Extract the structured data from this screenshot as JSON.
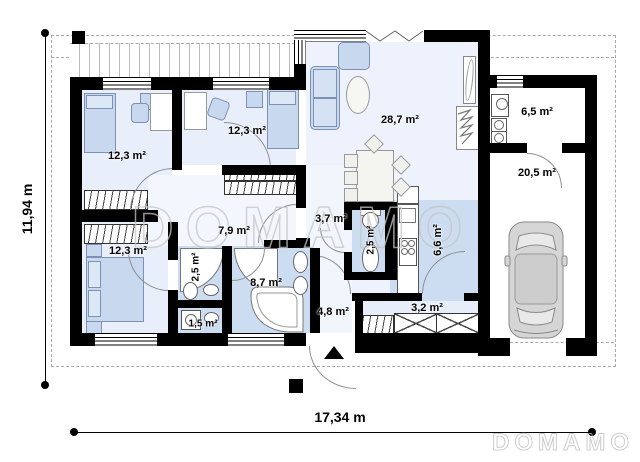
{
  "plan_title": "single-storey house floor plan with garage",
  "rooms": {
    "bedroom1": {
      "area": "12,3 m²"
    },
    "bedroom2": {
      "area": "12,3 m²"
    },
    "bedroom3": {
      "area": "12,3 m²"
    },
    "corridor": {
      "area": "7,9 m²"
    },
    "shower_room": {
      "area": "2,5 m²"
    },
    "wc_small": {
      "area": "1,5 m²"
    },
    "bathroom": {
      "area": "8,7 m²"
    },
    "hall": {
      "area": "3,7 m²"
    },
    "wc": {
      "area": "2,5 m²"
    },
    "kitchen": {
      "area": "6,6 m²"
    },
    "living_room": {
      "area": "28,7 m²"
    },
    "hallway": {
      "area": "4,8 m²"
    },
    "vestibule": {
      "area": "3,2 m²"
    },
    "utility": {
      "area": "6,5 m²"
    },
    "garage": {
      "area": "20,5 m²"
    }
  },
  "dimensions": {
    "width": "17,34 m",
    "height": "11,94 m"
  },
  "watermark": {
    "center": "DOMAMO",
    "footer": "DOMAMO"
  },
  "colors": {
    "wall": "#000000",
    "wet_room_floor": "#ccddf1",
    "bedroom_floor": "#e9effa",
    "living_floor": "#edf2fc",
    "furniture_fill": "#c7d8ef",
    "watermark_outline": "#c6c6c6"
  }
}
